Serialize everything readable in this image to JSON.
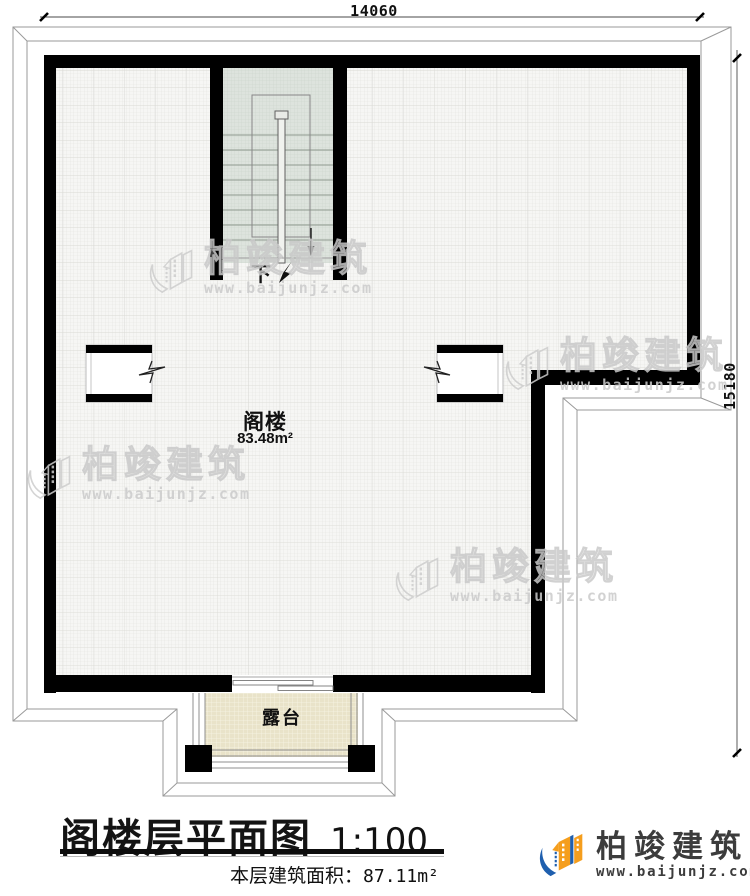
{
  "dimensions": {
    "top": "14060",
    "right": "15180"
  },
  "plan": {
    "room_label": "阁楼",
    "room_area": "83.48m²",
    "stair_label": "下",
    "terrace_label": "露台"
  },
  "watermark": {
    "brand": "柏竣建筑",
    "url": "www.baijunjz.com"
  },
  "title_block": {
    "title": "阁楼层平面图",
    "scale": "1:100",
    "area_label": "本层建筑面积：",
    "area_value": "87.11m²"
  },
  "logo": {
    "brand": "柏竣建筑",
    "url": "www.baijunjz.com"
  },
  "colors": {
    "wall": "#000000",
    "floor_bg": "#f6f6f4",
    "stair_bg": "#dde3dd",
    "terrace_bg": "#e9e3c9",
    "roof_line": "#9a9a9a",
    "watermark": "#c9c9c9",
    "logo_blue": "#1f5fae",
    "logo_orange": "#f59e1d"
  }
}
